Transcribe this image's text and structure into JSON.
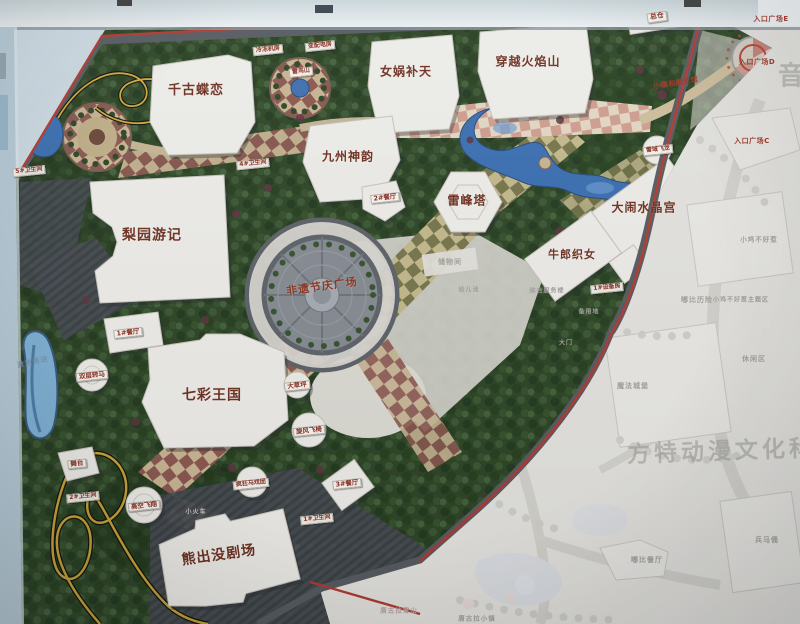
{
  "labels": {
    "buildings": [
      {
        "text": "千古蝶恋",
        "x": 196,
        "y": 91,
        "fs": 13
      },
      {
        "text": "女娲补天",
        "x": 406,
        "y": 72,
        "fs": 12
      },
      {
        "text": "穿越火焰山",
        "x": 528,
        "y": 62,
        "fs": 12
      },
      {
        "text": "九州神韵",
        "x": 348,
        "y": 157,
        "fs": 12
      },
      {
        "text": "雷峰塔",
        "x": 467,
        "y": 201,
        "fs": 12
      },
      {
        "text": "大闹水晶宫",
        "x": 644,
        "y": 208,
        "fs": 12
      },
      {
        "text": "牛郎织女",
        "x": 572,
        "y": 255,
        "fs": 11
      },
      {
        "text": "梨园游记",
        "x": 152,
        "y": 236,
        "fs": 14
      },
      {
        "text": "七彩王国",
        "x": 212,
        "y": 396,
        "fs": 14
      },
      {
        "text": "熊出没剧场",
        "x": 219,
        "y": 556,
        "fs": 14,
        "rot": -8
      },
      {
        "text": "非遗节庆广场",
        "x": 322,
        "y": 287,
        "fs": 11,
        "rot": -8,
        "c": "#8a3622"
      }
    ],
    "tags": [
      {
        "text": "总仓",
        "x": 657,
        "y": 17,
        "fs": 7,
        "rot": -8
      },
      {
        "text": "冷冻机房",
        "x": 268,
        "y": 50,
        "fs": 6,
        "rot": -6
      },
      {
        "text": "变配电房",
        "x": 320,
        "y": 46,
        "fs": 6,
        "rot": -6
      },
      {
        "text": "雷鸟山",
        "x": 301,
        "y": 72,
        "fs": 6,
        "rot": -6
      },
      {
        "text": "4#卫生间",
        "x": 253,
        "y": 164,
        "fs": 6,
        "rot": -6
      },
      {
        "text": "5#卫生间",
        "x": 29,
        "y": 171,
        "fs": 6,
        "rot": -6
      },
      {
        "text": "2#餐厅",
        "x": 385,
        "y": 198,
        "fs": 6.5,
        "rot": -6
      },
      {
        "text": "1#餐厅",
        "x": 128,
        "y": 333,
        "fs": 6.5,
        "rot": -6
      },
      {
        "text": "3#餐厅",
        "x": 347,
        "y": 484,
        "fs": 6.5,
        "rot": -6
      },
      {
        "text": "1#卫生间",
        "x": 317,
        "y": 519,
        "fs": 6,
        "rot": -6
      },
      {
        "text": "2#卫生间",
        "x": 83,
        "y": 497,
        "fs": 6,
        "rot": -6
      },
      {
        "text": "舞台",
        "x": 77,
        "y": 464,
        "fs": 6.5,
        "rot": -6
      },
      {
        "text": "高空飞翔",
        "x": 144,
        "y": 506,
        "fs": 6.5,
        "rot": -6
      },
      {
        "text": "疯狂马戏团",
        "x": 251,
        "y": 484,
        "fs": 6,
        "rot": -6
      },
      {
        "text": "大草坪",
        "x": 297,
        "y": 386,
        "fs": 6.5,
        "rot": -6
      },
      {
        "text": "旋风飞椅",
        "x": 309,
        "y": 431,
        "fs": 6.5,
        "rot": -6
      },
      {
        "text": "双层转马",
        "x": 92,
        "y": 376,
        "fs": 6.5,
        "rot": -6
      },
      {
        "text": "雪域飞龙",
        "x": 658,
        "y": 150,
        "fs": 6,
        "rot": -6
      },
      {
        "text": "1#设备房",
        "x": 607,
        "y": 288,
        "fs": 6,
        "rot": -6
      }
    ],
    "entrances": [
      {
        "text": "入口广场E",
        "x": 771,
        "y": 20,
        "fs": 7
      },
      {
        "text": "入口广场D",
        "x": 757,
        "y": 63,
        "fs": 7
      },
      {
        "text": "入口广场C",
        "x": 752,
        "y": 142,
        "fs": 7
      },
      {
        "text": "小镇和展示馆",
        "x": 676,
        "y": 84,
        "fs": 7,
        "rot": -10
      }
    ],
    "faded": [
      {
        "text": "储物间",
        "x": 450,
        "y": 263,
        "fs": 7
      },
      {
        "text": "幼儿池",
        "x": 469,
        "y": 291,
        "fs": 6
      },
      {
        "text": "综合服务楼",
        "x": 547,
        "y": 292,
        "fs": 6
      },
      {
        "text": "嘟比历险",
        "x": 697,
        "y": 301,
        "fs": 7
      },
      {
        "text": "小鸡不好惹",
        "x": 759,
        "y": 240,
        "fs": 6.5
      },
      {
        "text": "小鸡不好惹主题区",
        "x": 741,
        "y": 301,
        "fs": 6
      },
      {
        "text": "休闲区",
        "x": 754,
        "y": 360,
        "fs": 7
      },
      {
        "text": "魔法城堡",
        "x": 633,
        "y": 387,
        "fs": 7
      },
      {
        "text": "嘟比餐厅",
        "x": 647,
        "y": 561,
        "fs": 7
      },
      {
        "text": "兵马俑",
        "x": 767,
        "y": 541,
        "fs": 7
      },
      {
        "text": "唐古拉雪山",
        "x": 399,
        "y": 611,
        "fs": 6.5,
        "c": "#b9a3a3"
      },
      {
        "text": "唐古拉小镇",
        "x": 477,
        "y": 619,
        "fs": 6.5
      },
      {
        "text": "备用地",
        "x": 589,
        "y": 313,
        "fs": 6
      },
      {
        "text": "大门",
        "x": 566,
        "y": 344,
        "fs": 6
      },
      {
        "text": "小火车",
        "x": 196,
        "y": 513,
        "fs": 6,
        "c": "#c2c6c0"
      },
      {
        "text": "激流勇进",
        "x": 33,
        "y": 363,
        "fs": 7,
        "rot": -12,
        "c": "rgba(126,147,168,.85)"
      }
    ],
    "watermarks": [
      {
        "text": "方特动漫文化科技",
        "x": 735,
        "y": 452,
        "fs": 23,
        "rot": -2
      },
      {
        "text": "音",
        "x": 793,
        "y": 77,
        "fs": 26
      }
    ]
  }
}
